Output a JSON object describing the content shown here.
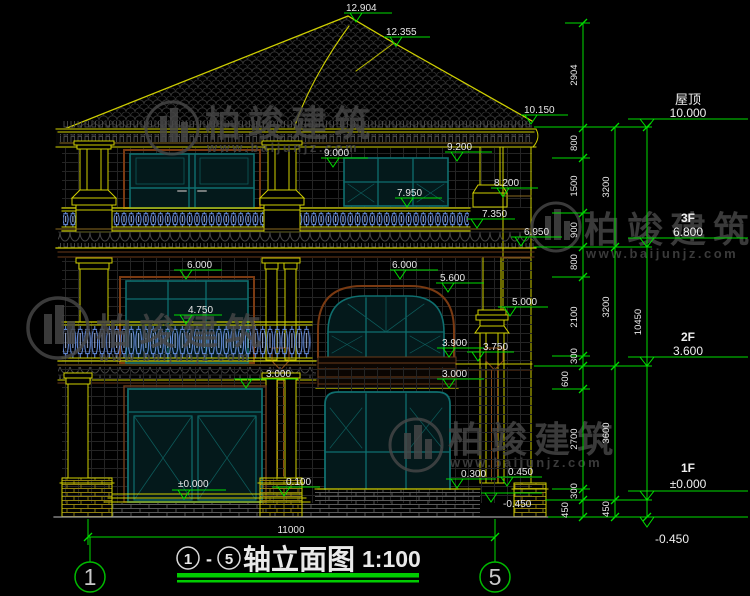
{
  "drawing": {
    "title": {
      "axis_from": "1",
      "dash": "-",
      "axis_to": "5",
      "name": "轴立面图",
      "scale": "1:100"
    },
    "axis_bubbles": {
      "left": "1",
      "right": "5"
    }
  },
  "watermark": {
    "brand": "柏竣建筑",
    "url": "www.baijunjz.com"
  },
  "markers": {
    "ridge": "12.904",
    "ridge2": "12.355",
    "eave_right": "10.150",
    "f3_win_right_top": "9.200",
    "f3_win_left_top": "9.000",
    "f3_bracket_top": "8.200",
    "f3_win_sill": "7.950",
    "f3_rail_bottom": "7.350",
    "band_bottom": "6.950",
    "f2_win_left_top": "6.000",
    "f2_arch_frame_top": "6.000",
    "f2_arch_top": "5.600",
    "f2_cap_top": "5.000",
    "f2_rail_top": "4.750",
    "f2_win_bottom": "3.900",
    "spout_box_top": "3.750",
    "f1_door_top": "3.000",
    "f1_win_top": "3.000",
    "porch_floor": "0.100",
    "f1_zero": "±0.000",
    "f1_win_sill": "0.300",
    "plinth_top": "0.450",
    "ground_right": "-0.450"
  },
  "levels": {
    "roof": {
      "label": "屋顶",
      "value": "10.000"
    },
    "f3": {
      "label": "3F",
      "value": "6.800"
    },
    "f2": {
      "label": "2F",
      "value": "3.600"
    },
    "f1": {
      "label": "1F",
      "value": "±0.000"
    },
    "ground": {
      "value": "-0.450"
    }
  },
  "dims": {
    "overall_width": "11000",
    "col1": [
      "2904",
      "800",
      "1500",
      "900",
      "800",
      "2100",
      "300",
      "600",
      "2700",
      "300",
      "450"
    ],
    "col2": [
      "3200",
      "3200",
      "3600",
      "450"
    ],
    "col3": [
      "10450"
    ]
  },
  "colors": {
    "dim_green": "#00dd00",
    "build_yellow": "#cfcf00",
    "frame_teal": "#0f6f6f",
    "baluster_blue": "#6b94e8",
    "frame_brown": "#7a3a12",
    "text_white": "#e8e8e8",
    "watermark_gray": "#474747",
    "background": "#000000"
  }
}
